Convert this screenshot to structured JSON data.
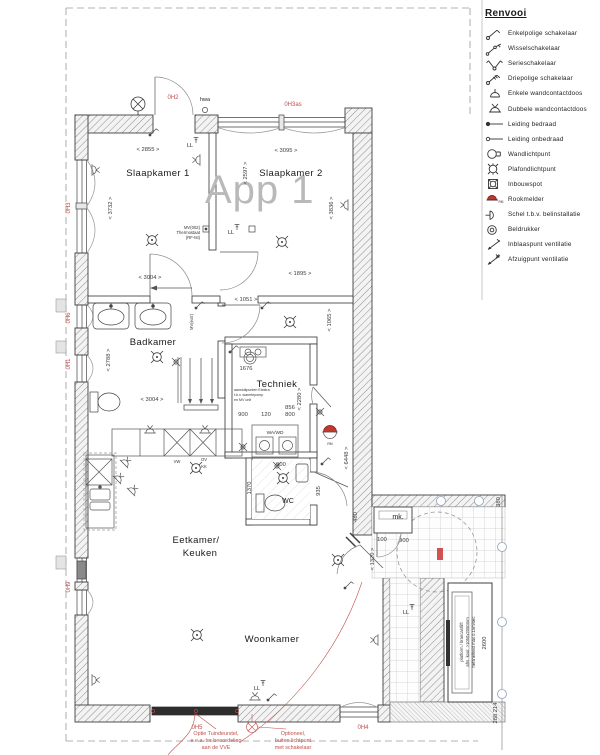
{
  "legend": {
    "title": "Renvooi",
    "items": [
      {
        "icon": "single-pole-switch",
        "label": "Enkelpolige schakelaar"
      },
      {
        "icon": "two-way-switch",
        "label": "Wisselschakelaar"
      },
      {
        "icon": "series-switch",
        "label": "Serieschakelaar"
      },
      {
        "icon": "three-pole-switch",
        "label": "Driepolige schakelaar"
      },
      {
        "icon": "single-socket",
        "label": "Enkele wandcontactdoos"
      },
      {
        "icon": "double-socket",
        "label": "Dubbele wandcontactdoos"
      },
      {
        "icon": "wired-conduit",
        "label": "Leiding bedraad"
      },
      {
        "icon": "unwired-conduit",
        "label": "Leiding onbedraad"
      },
      {
        "icon": "wall-light",
        "label": "Wandlichtpunt"
      },
      {
        "icon": "ceiling-light",
        "label": "Plafondlichtpunt"
      },
      {
        "icon": "recessed-spot",
        "label": "Inbouwspot"
      },
      {
        "icon": "smoke-detector",
        "label": "Rookmelder"
      },
      {
        "icon": "bell",
        "label": "Schel t.b.v. belinstallatie"
      },
      {
        "icon": "bell-push",
        "label": "Beldrukker"
      },
      {
        "icon": "supply-vent",
        "label": "Inblaaspunt ventilatie"
      },
      {
        "icon": "extract-vent",
        "label": "Afzuigpunt ventilatie"
      }
    ]
  },
  "plan": {
    "app_label": "App 1",
    "rooms": {
      "slaapkamer1": "Slaapkamer 1",
      "slaapkamer2": "Slaapkamer 2",
      "badkamer": "Badkamer",
      "techniek": "Techniek",
      "eetkamer1": "Eetkamer/",
      "eetkamer2": "Keuken",
      "woonkamer": "Woonkamer",
      "wc": "WC",
      "mk": "mk."
    },
    "dims": {
      "d2855": "< 2855 >",
      "d3095": "< 3095 >",
      "d3732": "< 3732 >",
      "d3836": "< 3836 >",
      "d2597": "< 2597 >",
      "d3004a": "< 3004 >",
      "d1051": "< 1051 >",
      "d1895": "< 1895 >",
      "d2788": "< 2788 >",
      "d3004b": "< 3004 >",
      "d1065": "< 1065 >",
      "d1676": "1676",
      "d2280": "< 2280 >",
      "d856": "856",
      "d800": "800",
      "d900a": "900",
      "d120": "120",
      "d900b": "900",
      "d900c": "900",
      "d6448": "< 6448 >",
      "d480": "480",
      "d1320": "< 1320 >",
      "d100": "100",
      "d935": "935",
      "d1370": "1370",
      "d380": "380",
      "d2600": "2600",
      "d288": "288 214"
    },
    "red": {
      "oh2": "0H2",
      "oh3as": "0H3as",
      "oh3": "0H3",
      "oh6": "0H6",
      "oh1": "0H1",
      "oh9": "0H9",
      "oh5": "0H5",
      "oh4": "0H4",
      "note1a": "Optie Tuindeurstel,",
      "note1b": "e.e.a. ter beoordeling",
      "note1c": "aan de VVE",
      "note2a": "Optioneel,",
      "note2b": "buiten lichtpunt",
      "note2c": "met schakelaar"
    },
    "labels": {
      "hwa": "hwa",
      "ll": "LL",
      "mv002": "MV(002)",
      "thermostaat": "Thermostaat",
      "rftst": "(RF-tst)",
      "mvextr": "MV(extr)",
      "wawd": "WA/WD",
      "vw": "VW",
      "ov": "OV",
      "kk": "KK",
      "tech1": "aansluitpunten Elektra",
      "tech2": "t.b.v. warmtepomp",
      "tech3": "en MV unit",
      "lift1": "platform / brancardlift",
      "lift2": "afm. kooi: >1050x2050mm",
      "lift3": "hefsnelheid max 0.15m/sec",
      "rm": "RM"
    }
  },
  "colors": {
    "red": "#c0504d",
    "wall": "#3f3f3f"
  }
}
